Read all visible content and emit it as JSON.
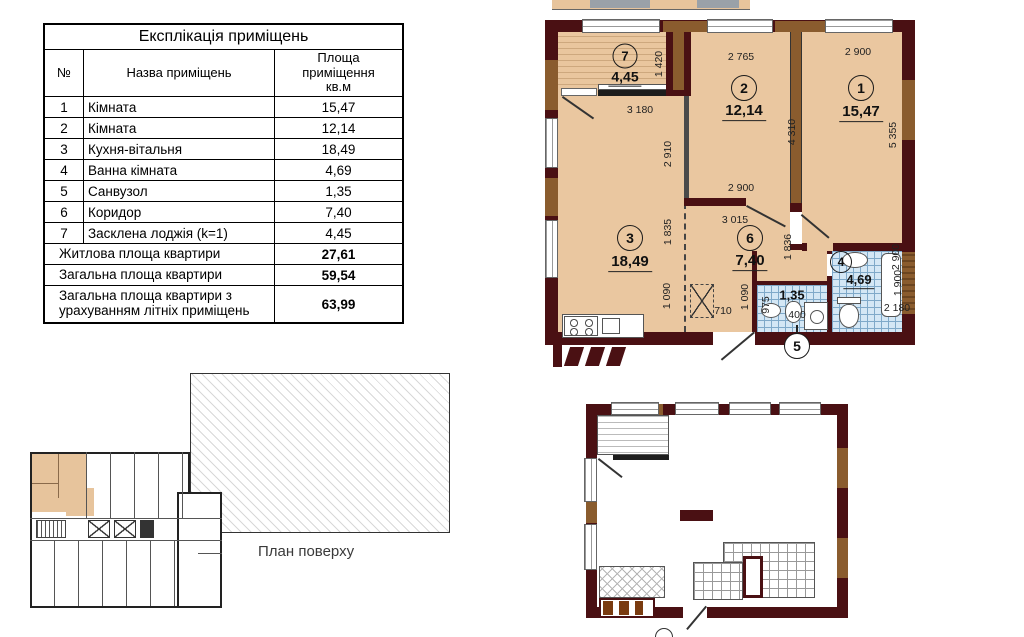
{
  "explication_table": {
    "title": "Експлікація приміщень",
    "columns": {
      "num": "№",
      "name": "Назва приміщень",
      "area": "Площа\nприміщення\nкв.м"
    },
    "rows": [
      {
        "num": "1",
        "name": "Кімната",
        "area": "15,47"
      },
      {
        "num": "2",
        "name": "Кімната",
        "area": "12,14"
      },
      {
        "num": "3",
        "name": "Кухня-вітальня",
        "area": "18,49"
      },
      {
        "num": "4",
        "name": "Ванна кімната",
        "area": "4,69"
      },
      {
        "num": "5",
        "name": "Санвузол",
        "area": "1,35"
      },
      {
        "num": "6",
        "name": "Коридор",
        "area": "7,40"
      },
      {
        "num": "7",
        "name": "Засклена лоджія (k=1)",
        "area": "4,45"
      }
    ],
    "summary": [
      {
        "label": "Житлова площа квартири",
        "value": "27,61",
        "tall": false
      },
      {
        "label": "Загальна площа квартири",
        "value": "59,54",
        "tall": false
      },
      {
        "label": "Загальна площа квартири з урахуванням літніх приміщень",
        "value": "63,99",
        "tall": true
      }
    ]
  },
  "apartment_plan": {
    "rooms": [
      {
        "num": "1",
        "area": "15,47",
        "cx": 316,
        "cy": 88,
        "ax": 316,
        "ay": 113,
        "size": "lg"
      },
      {
        "num": "2",
        "area": "12,14",
        "cx": 199,
        "cy": 88,
        "ax": 199,
        "ay": 112,
        "size": "lg"
      },
      {
        "num": "3",
        "area": "18,49",
        "cx": 85,
        "cy": 238,
        "ax": 85,
        "ay": 263,
        "size": "lg"
      },
      {
        "num": "6",
        "area": "7,40",
        "cx": 205,
        "cy": 238,
        "ax": 205,
        "ay": 262,
        "size": "lg"
      },
      {
        "num": "7",
        "area": "4,45",
        "cx": 80,
        "cy": 56,
        "ax": 80,
        "ay": 78,
        "size": "md"
      },
      {
        "num": "4",
        "area": "4,69",
        "cx": 296,
        "cy": 262,
        "ax": 314,
        "ay": 281,
        "size": "sm"
      }
    ],
    "wc_area_label": "1,35",
    "callout_5": "5",
    "dimensions": [
      {
        "t": "1 420",
        "x": 114,
        "y": 64,
        "v": true
      },
      {
        "t": "2 765",
        "x": 196,
        "y": 57,
        "v": false
      },
      {
        "t": "2 900",
        "x": 313,
        "y": 52,
        "v": false
      },
      {
        "t": "3 180",
        "x": 95,
        "y": 110,
        "v": false
      },
      {
        "t": "4 310",
        "x": 247,
        "y": 132,
        "v": true
      },
      {
        "t": "5 355",
        "x": 348,
        "y": 135,
        "v": true
      },
      {
        "t": "2 910",
        "x": 123,
        "y": 154,
        "v": true
      },
      {
        "t": "2 900",
        "x": 196,
        "y": 188,
        "v": false
      },
      {
        "t": "3 015",
        "x": 190,
        "y": 220,
        "v": false
      },
      {
        "t": "1 835",
        "x": 123,
        "y": 232,
        "v": true
      },
      {
        "t": "1 836",
        "x": 243,
        "y": 247,
        "v": true
      },
      {
        "t": "1 090",
        "x": 122,
        "y": 296,
        "v": true
      },
      {
        "t": "1 090",
        "x": 200,
        "y": 297,
        "v": true
      },
      {
        "t": "710",
        "x": 178,
        "y": 311,
        "v": false
      },
      {
        "t": "975",
        "x": 221,
        "y": 305,
        "v": true
      },
      {
        "t": "400",
        "x": 252,
        "y": 315,
        "v": false
      },
      {
        "t": "2 900",
        "x": 351,
        "y": 257,
        "v": true
      },
      {
        "t": "1 900",
        "x": 353,
        "y": 283,
        "v": true
      },
      {
        "t": "2 180",
        "x": 352,
        "y": 308,
        "v": false
      }
    ]
  },
  "floor_plan": {
    "caption": "План поверху"
  },
  "colors": {
    "room_fill": "#eac7a0",
    "wall_dark": "#4a1013",
    "wall_wood": "#8a5c2e",
    "tile_fill": "#d4e7f5",
    "tile_line": "#7fa9c9"
  }
}
